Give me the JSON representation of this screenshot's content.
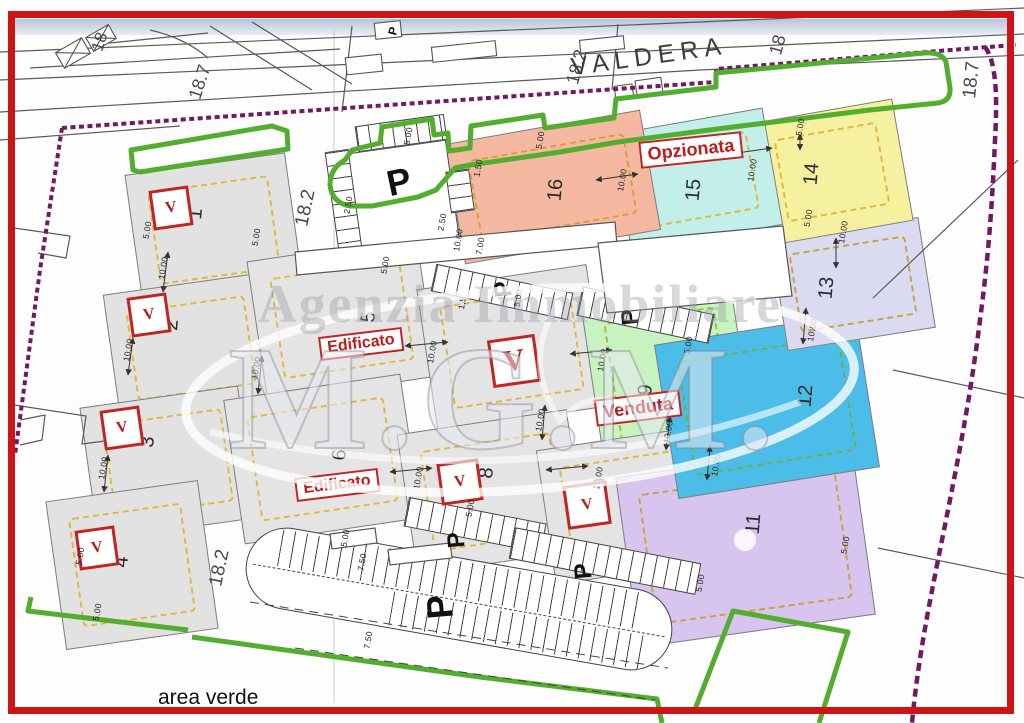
{
  "map": {
    "street_name": "VALDERA",
    "area_label": "area verde",
    "elevations": {
      "tl_18": "18",
      "tl_18_7": "18.7",
      "left_18_2_a": "18.2",
      "left_18_2_b": "18.2",
      "top_18_2": "18.2",
      "top_18": "18",
      "tr_18_7": "18.7"
    },
    "status_labels": {
      "edificato": "Edificato",
      "venduta": "Venduta",
      "opzionata": "Opzionata",
      "sold_mark": "V",
      "parking_mark": "P"
    },
    "dims": {
      "d5": "5.00",
      "d10": "10.00",
      "d7": "7.00",
      "d75": "7.50",
      "d25": "2.50",
      "d15": "1.50",
      "d1_5": "1,5"
    },
    "lot_numbers": {
      "n1": "1",
      "n2": "2",
      "n3": "3",
      "n4": "4",
      "n5": "5",
      "n6": "6",
      "n8": "8",
      "n9": "9",
      "n10": "10",
      "n11": "11",
      "n12": "12",
      "n13": "13",
      "n14": "14",
      "n15": "15",
      "n16": "16"
    },
    "watermark": {
      "line1": "Agenzia Immobiliare",
      "line2": "M.G.M."
    },
    "colors": {
      "frame": "#cf1418",
      "boundary_purple": "#701a63",
      "boundary_green": "#53ad2f",
      "lot_gray": "#e2e2e2",
      "lot9_green": "#c8f2c0",
      "lot11_purple": "#d7c5ef",
      "lot12_blue": "#4cbce8",
      "lot13_lavender": "#dadaf0",
      "lot14_yellow": "#f6f1a0",
      "lot15_cyan": "#c3efeb",
      "lot16_salmon": "#f5b8a1",
      "footprint_dash": "#ddb93f",
      "marker_red": "#bb1b1b"
    }
  }
}
